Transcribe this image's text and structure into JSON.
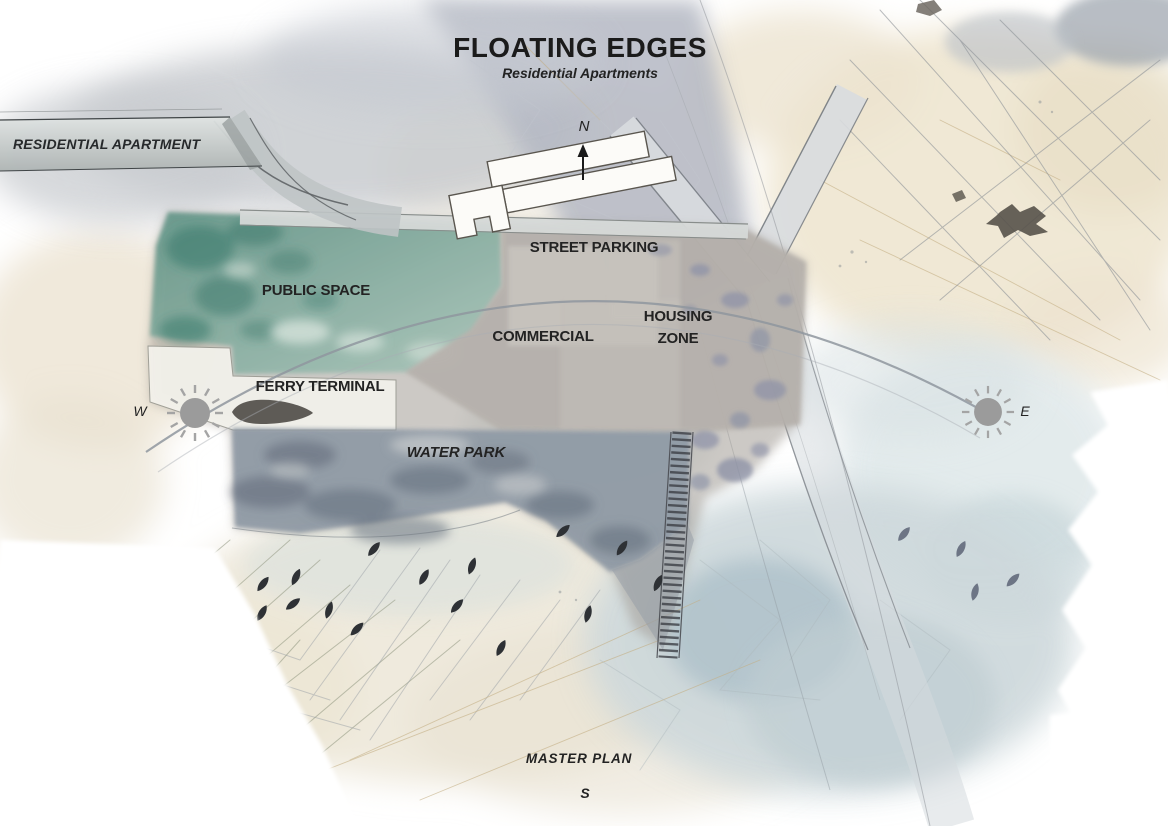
{
  "title": {
    "main": "FLOATING EDGES",
    "subtitle": "Residential Apartments"
  },
  "banner": {
    "label": "RESIDENTIAL APARTMENT"
  },
  "plan": {
    "zones": {
      "street_parking": "STREET PARKING",
      "public_space": "PUBLIC SPACE",
      "commercial": "COMMERCIAL",
      "housing_zone": "HOUSING ZONE",
      "ferry_terminal": "FERRY TERMINAL",
      "water_park": "WATER PARK"
    },
    "caption": "MASTER PLAN"
  },
  "compass": {
    "north": "N",
    "south": "S",
    "west": "W",
    "east": "E"
  },
  "icons": {
    "west": "sun-icon",
    "east": "sun-icon",
    "north": "north-arrow-icon",
    "ferry": "boat-shape",
    "pier": "boardwalk-pier"
  },
  "colors": {
    "public_space_teal": "#47857a",
    "site_gray": "#a8a29b",
    "water_park_blue_gray": "#8a95a2",
    "housing_speckle": "#8b90a6",
    "road_gray": "#d6d9d8",
    "paper_beige": "#ede5d2",
    "wash_blue": "#c9d6da",
    "wash_gray": "#b7bbc4",
    "leaf_dark": "#2e3135",
    "sun_gray": "#9b9b9b",
    "text_dark": "#1f1f1f"
  }
}
